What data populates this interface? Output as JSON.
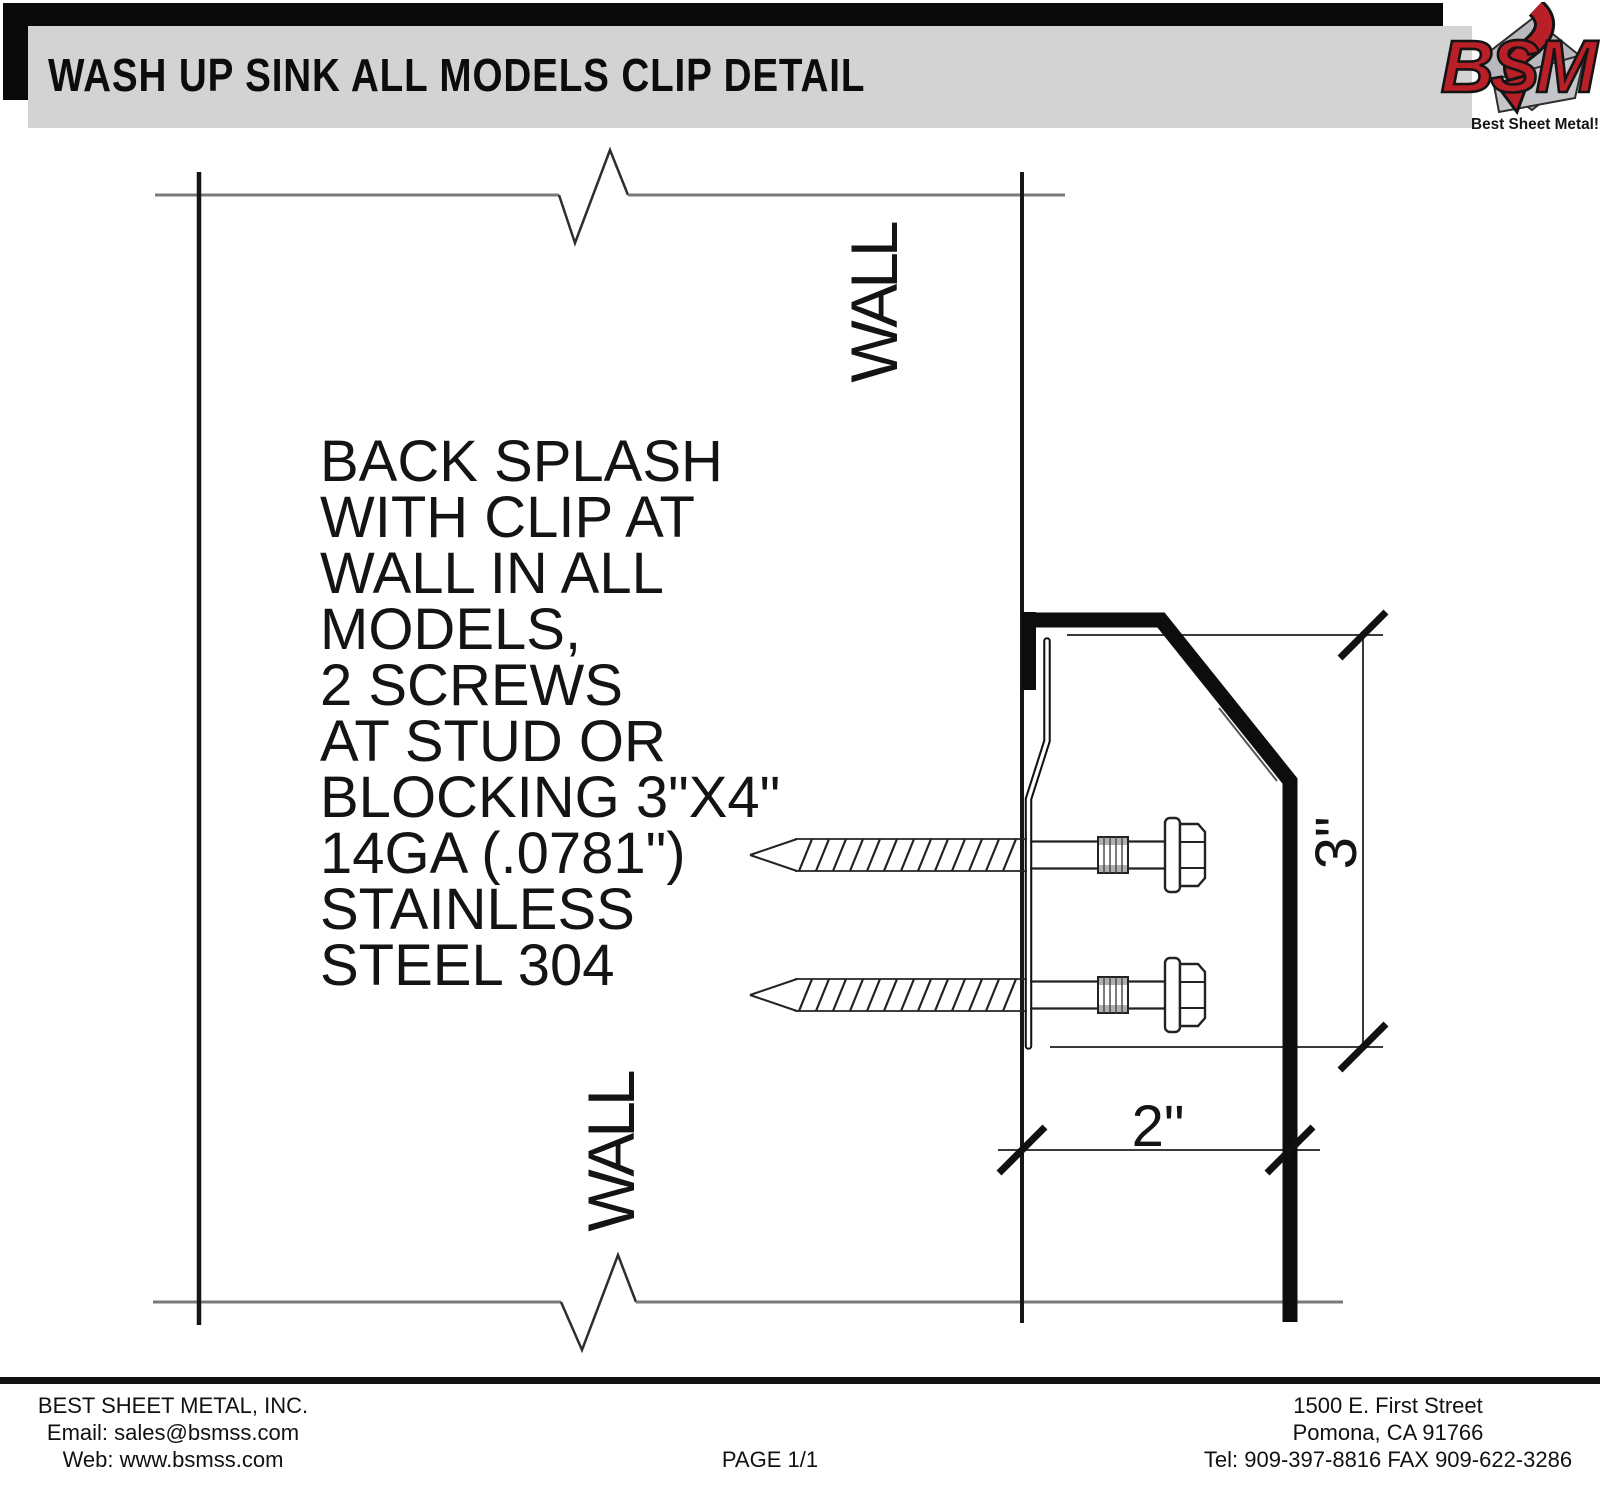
{
  "header": {
    "title": "WASH UP SINK ALL MODELS CLIP DETAIL"
  },
  "logo": {
    "acronym": "BSM",
    "tagline": "Best Sheet Metal!",
    "red": "#b81f27",
    "gray": "#b7b9bd"
  },
  "drawing": {
    "wall_label_top": "WALL",
    "wall_label_bottom": "WALL",
    "note": "BACK SPLASH\nWITH CLIP AT\nWALL IN ALL\nMODELS,\n2 SCREWS\nAT STUD OR\nBLOCKING 3\"X4\"\n14GA (.0781\")\nSTAINLESS\nSTEEL 304",
    "dim_height": "3\"",
    "dim_depth": "2\""
  },
  "footer": {
    "company": "BEST SHEET METAL, INC.",
    "email": "Email: sales@bsmss.com",
    "web": "Web: www.bsmss.com",
    "page": "PAGE 1/1",
    "address1": "1500 E. First Street",
    "address2": "Pomona, CA 91766",
    "phone": "Tel: 909-397-8816 FAX 909-622-3286"
  }
}
